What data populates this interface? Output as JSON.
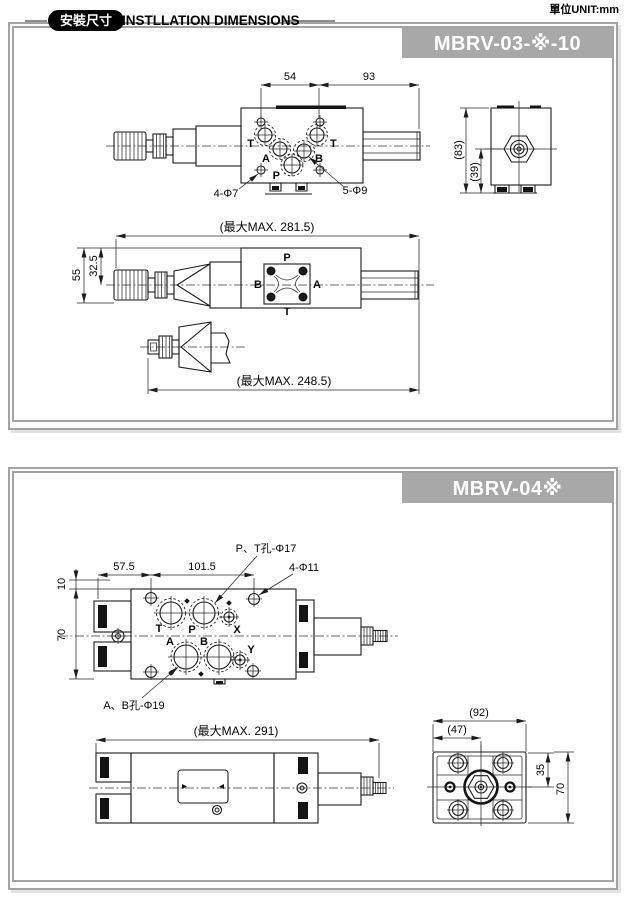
{
  "unit_label": "單位UNIT:mm",
  "header": {
    "badge": "安裝尺寸",
    "title": "INSTLLATION DIMENSIONS"
  },
  "mbrv03": {
    "model": "MBRV-03-※-10",
    "top_view": {
      "dim_54": "54",
      "dim_93": "93",
      "port_t_left": "T",
      "port_a": "A",
      "port_b": "B",
      "port_t_right": "T",
      "port_p": "P",
      "callout_4_holes": "4-Φ7",
      "callout_5_holes": "5-Φ9"
    },
    "side_view": {
      "dim_max": "(最大MAX. 281.5)",
      "dim_55": "55",
      "dim_32_5": "32.5",
      "port_p": "P",
      "port_b": "B",
      "port_a": "A",
      "port_t": "T"
    },
    "alt_view": {
      "dim_max": "(最大MAX. 248.5)"
    },
    "end_view": {
      "dim_83": "(83)",
      "dim_39": "(39)"
    }
  },
  "mbrv04": {
    "model": "MBRV-04※",
    "top_view": {
      "callout_pt": "P、T孔-Φ17",
      "callout_411": "4-Φ11",
      "callout_ab": "A、B孔-Φ19",
      "dim_10": "10",
      "dim_57_5": "57.5",
      "dim_101_5": "101.5",
      "dim_70": "70",
      "port_t": "T",
      "port_p": "P",
      "port_x": "X",
      "port_a": "A",
      "port_b": "B",
      "port_y": "Y"
    },
    "side_view": {
      "dim_max": "(最大MAX. 291)"
    },
    "end_view": {
      "dim_92": "(92)",
      "dim_47": "(47)",
      "dim_35": "35",
      "dim_70": "70"
    }
  }
}
